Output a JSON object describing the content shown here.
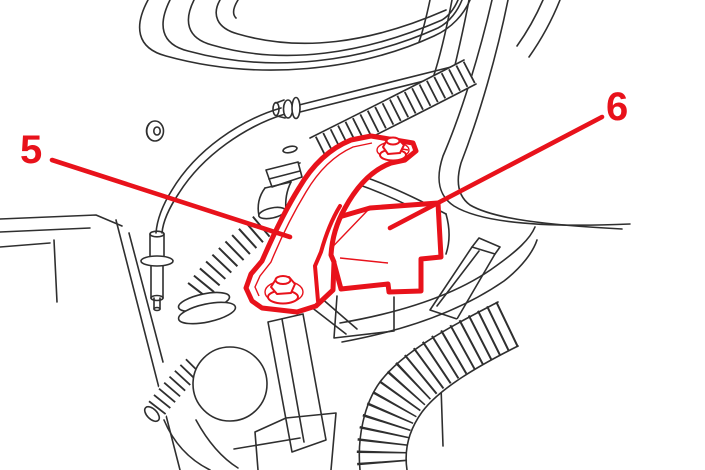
{
  "figure": {
    "type": "technical-illustration",
    "colors": {
      "background": "#ffffff",
      "line": "#2f2f2f",
      "highlight": "#e8121b"
    },
    "callouts": [
      {
        "label": "5"
      },
      {
        "label": "6"
      }
    ]
  }
}
